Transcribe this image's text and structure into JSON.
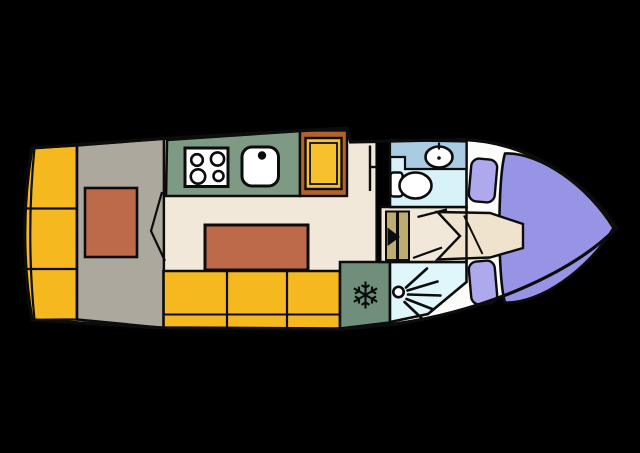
{
  "diagram": {
    "kind": "boat-floor-plan",
    "width": 640,
    "height": 453
  },
  "colors": {
    "background": "#000000",
    "line": "#0c0c0c",
    "hull": "#fcfcfa",
    "berth_yellow": "#f6b81f",
    "cabin_gray": "#aca89e",
    "mattress_orange": "#bd6a4b",
    "floor_cream": "#f1e8da",
    "counter_green": "#7e9a85",
    "fridge_green": "#6f8f7a",
    "cabinet_brown": "#b2622f",
    "cabinet_yellow": "#f6c12c",
    "steps_khaki": "#bfac70",
    "bath_floor": "#d7f2f8",
    "bath_counter": "#a9cce2",
    "shower_floor": "#dff6fa",
    "deck_purple": "#9894e5",
    "cushion_purple": "#aea9ed",
    "fixture_white": "#ffffff",
    "berth_beige": "#f0e3ce",
    "icon_black": "#0c0c0c"
  },
  "icons": {
    "freezer": {
      "name": "snowflake-icon",
      "glyph": "❄"
    },
    "shower": {
      "name": "shower-head-icon"
    },
    "stove": {
      "name": "stove-burners-icon"
    },
    "sink": {
      "name": "kitchen-sink-icon"
    },
    "basin": {
      "name": "wash-basin-icon"
    },
    "toilet": {
      "name": "toilet-icon"
    }
  }
}
